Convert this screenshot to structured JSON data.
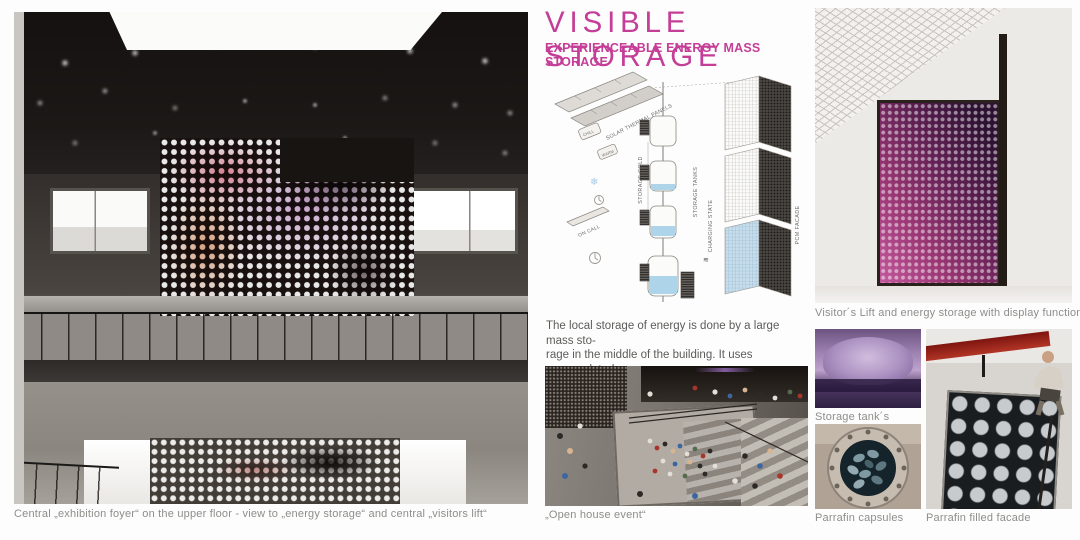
{
  "board": {
    "title": "VISIBLE STORAGE",
    "subtitle": "EXPERIENCEABLE ENERGY MASS STORAGE",
    "accent_color": "#c43e97"
  },
  "diagram": {
    "labels": {
      "solar_panels": "SOLAR THERMAL PANELS",
      "chill": "CHILL",
      "warm": "WARM",
      "storage_cold": "STORAGE COLD",
      "storage_tanks": "STORAGE TANKS",
      "charging_state": "CHARGING STATE",
      "on_call": "ON CALL",
      "pcm_facade": "PCM FACADE"
    }
  },
  "paragraph": {
    "lines": [
      "The local storage of energy is done by a large mass sto-",
      "rage in the middle of the building. It uses encapsulated",
      "paraffin as a highly efficient storage medium."
    ]
  },
  "captions": {
    "left_photo": "Central „exhibition foyer“ on the upper floor - view to „energy storage“ and central „visitors lift“",
    "open_house": "„Open house event“",
    "visitors_lift": "Visitor´s Lift and energy storage with display function",
    "storage_tanks": "Storage tank´s",
    "parrafin_capsules": "Parrafin capsules",
    "parrafin_facade": "Parrafin filled facade"
  }
}
